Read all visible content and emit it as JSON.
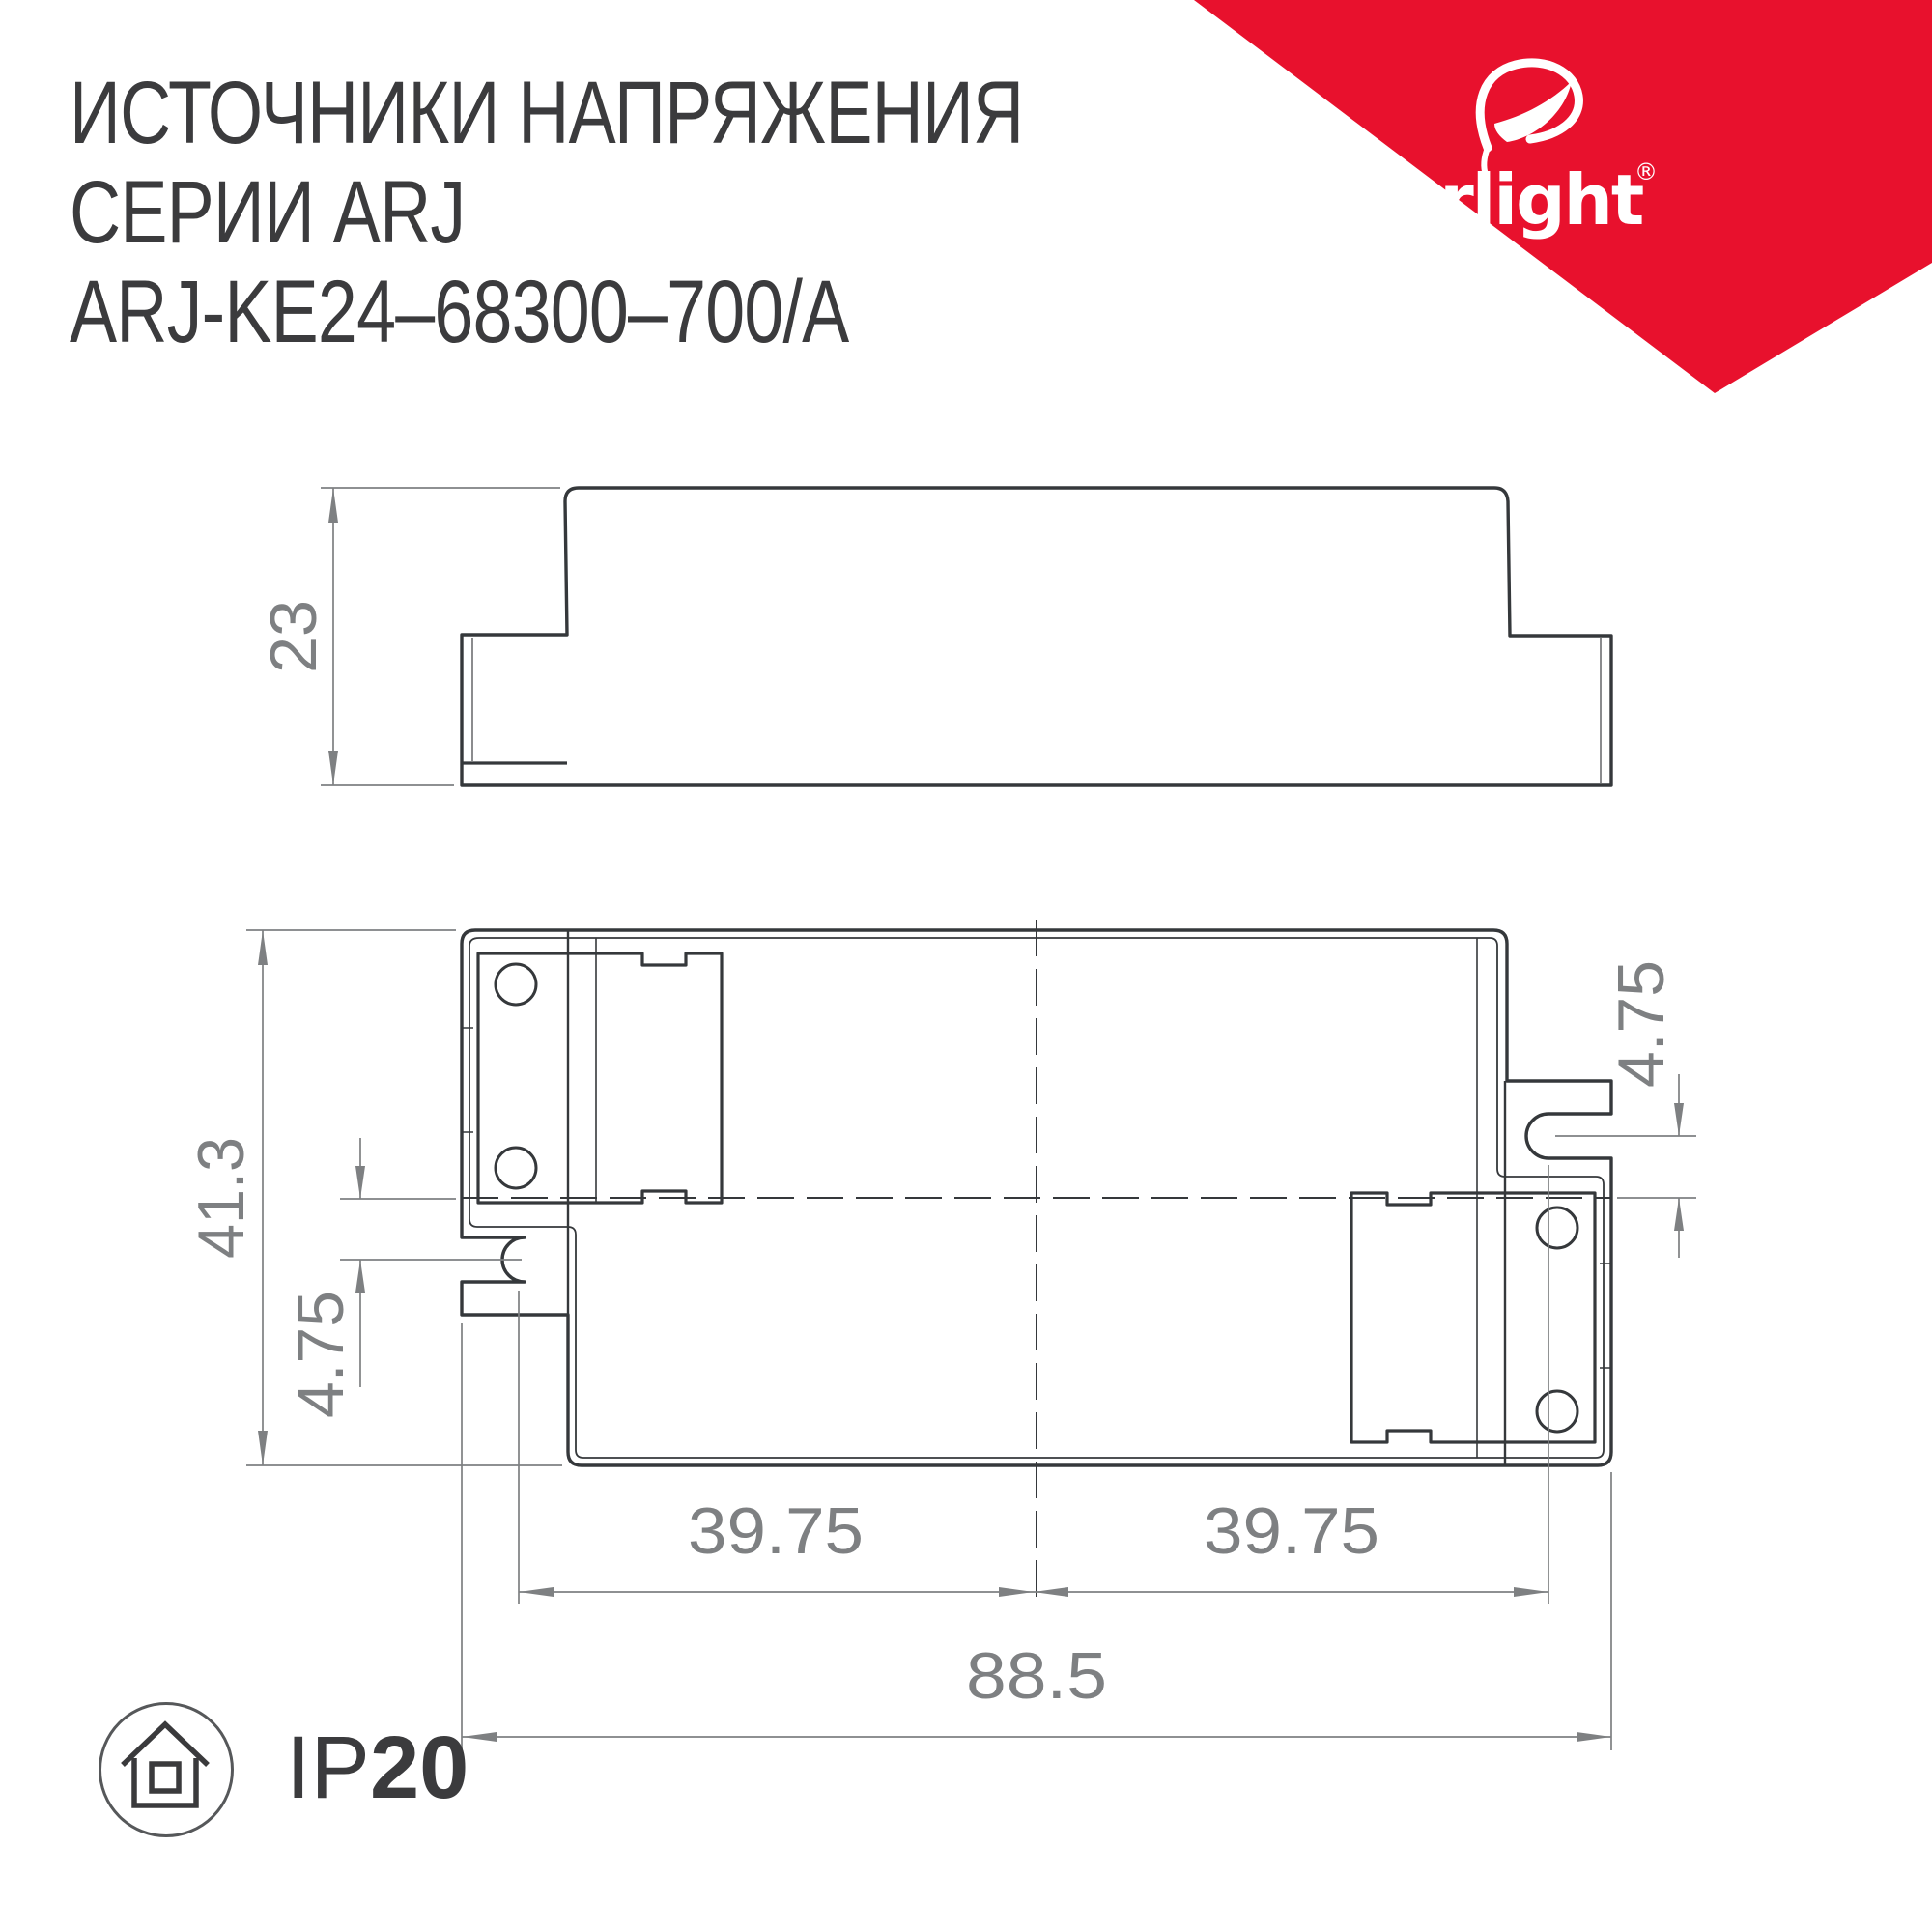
{
  "header": {
    "title_line1": "ИСТОЧНИКИ НАПРЯЖЕНИЯ",
    "title_line2": "СЕРИИ ARJ",
    "title_line3": "ARJ-KE24–68300–700/A"
  },
  "brand": {
    "name": "arlight",
    "registered_mark": "®",
    "triangle_color": "#e8112d"
  },
  "drawing": {
    "side_view": {
      "height_dim": "23"
    },
    "top_view": {
      "depth_dim": "41.3",
      "left_slot_offset_dim": "4.75",
      "right_slot_offset_dim": "4.75",
      "left_mount_span_dim": "39.75",
      "right_mount_span_dim": "39.75",
      "overall_width_dim": "88.5"
    },
    "line_color": "#35383b",
    "dim_color": "#7e8082"
  },
  "footer": {
    "ip_prefix": "IP",
    "ip_value": "20"
  }
}
